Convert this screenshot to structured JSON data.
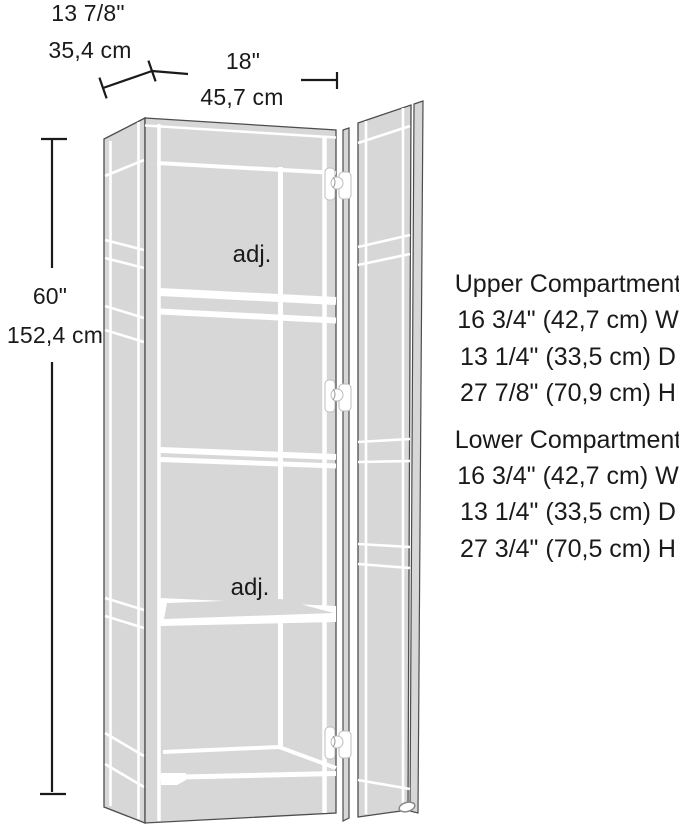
{
  "diagram": {
    "background_color": "#ffffff",
    "line_color": "#1a1a1a",
    "panel_color": "#d7d7d7",
    "dimensions": {
      "depth_inches": "13 7/8\"",
      "depth_cm": "35,4 cm",
      "width_inches": "18\"",
      "width_cm": "45,7 cm",
      "height_inches": "60\"",
      "height_cm": "152,4 cm"
    },
    "shelf_labels": {
      "upper": "adj.",
      "lower": "adj."
    },
    "compartments": {
      "upper": {
        "title": "Upper Compartment",
        "width": "16 3/4\" (42,7 cm) W",
        "depth": "13 1/4\" (33,5 cm) D",
        "height": "27 7/8\" (70,9 cm) H"
      },
      "lower": {
        "title": "Lower Compartment",
        "width": "16 3/4\" (42,7 cm) W",
        "depth": "13 1/4\" (33,5 cm) D",
        "height": "27 3/4\" (70,5 cm) H"
      }
    }
  }
}
